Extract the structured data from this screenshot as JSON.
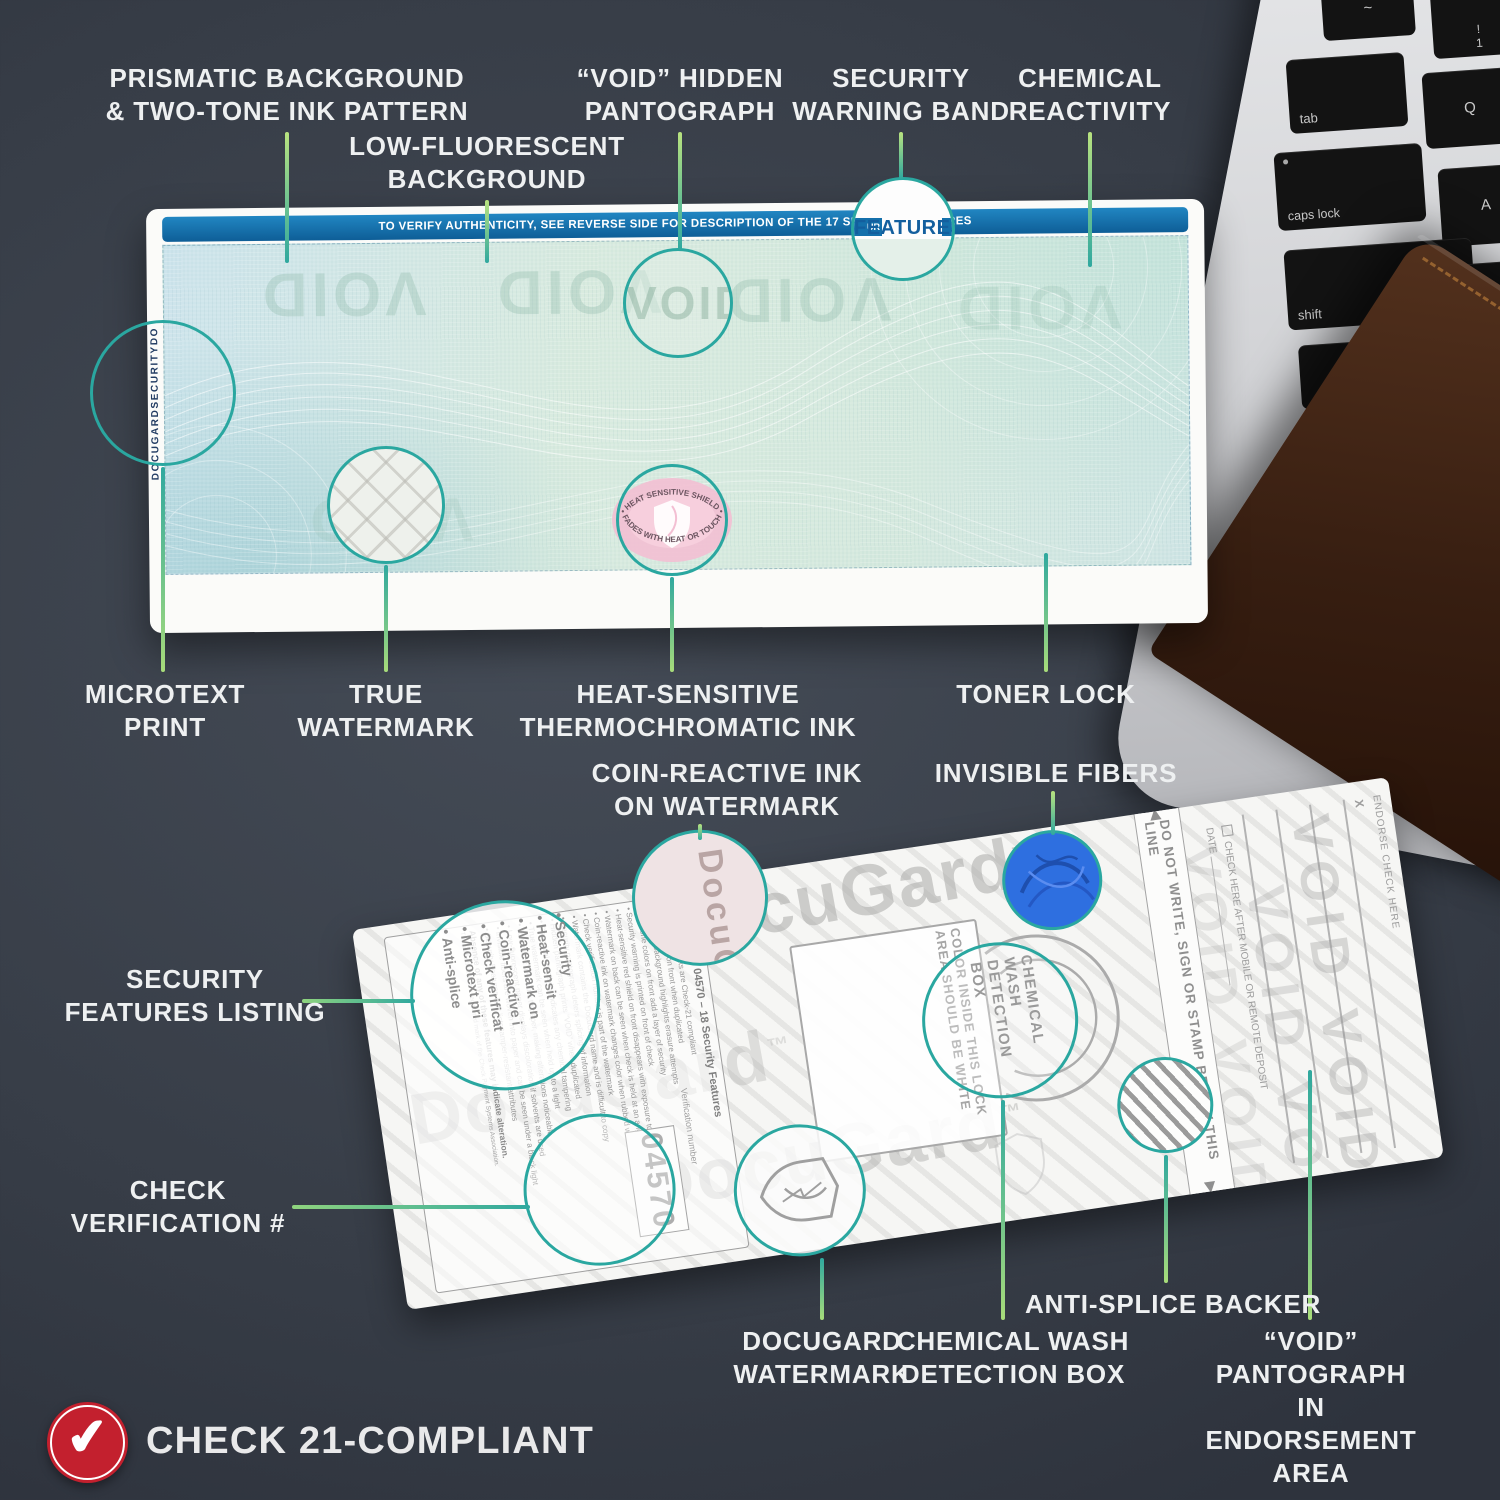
{
  "callouts": {
    "prismatic": "PRISMATIC BACKGROUND\n& TWO-TONE INK PATTERN",
    "low_fluorescent": "LOW-FLUORESCENT\nBACKGROUND",
    "void_hidden": "“VOID” HIDDEN\nPANTOGRAPH",
    "security_warning": "SECURITY\nWARNING BAND",
    "chemical_reactivity": "CHEMICAL\nREACTIVITY",
    "microtext_print": "MICROTEXT\nPRINT",
    "true_watermark": "TRUE\nWATERMARK",
    "heat_sensitive": "HEAT-SENSITIVE\nTHERMOCHROMATIC INK",
    "toner_lock": "TONER LOCK",
    "coin_reactive": "COIN-REACTIVE INK\nON WATERMARK",
    "invisible_fibers": "INVISIBLE FIBERS",
    "security_features_listing": "SECURITY\nFEATURES LISTING",
    "check_verification": "CHECK\nVERIFICATION #",
    "docugard_watermark": "DOCUGARD\nWATERMARK",
    "chemical_wash_box": "CHEMICAL WASH\nDETECTION BOX",
    "anti_splice": "ANTI-SPLICE BACKER",
    "void_endorsement": "“VOID” PANTOGRAPH\nIN ENDORSEMENT\nAREA"
  },
  "front_check": {
    "band_text": "TO VERIFY AUTHENTICITY, SEE REVERSE SIDE FOR DESCRIPTION OF THE 17 SECURITY FEATURES",
    "features_magnified": "FEATURES",
    "band_fragment": "UR",
    "void_text": "VOID",
    "microtext": "DOCUGARDSECURITYDO",
    "heat_shield_top": "• HEAT SENSITIVE SHIELD •",
    "heat_shield_bottom": "FADES WITH HEAT OR TOUCH"
  },
  "back_check": {
    "watermark_text": "DocuGard",
    "watermark_tm": "™",
    "listing": {
      "heading": "DocuGard 04570 – 18 Security Features",
      "bullets": [
        "DocuGard checks are Check-21 compliant",
        "Prints “VOID” on front when duplicated",
        "Patterned background highlights erasure attempts",
        "Two-tone colors on front add a layer of security",
        "Security warning is printed on front of check",
        "Heat-sensitive red shield on front disappears with exposure to heat or touch",
        "Watermark on back can be seen when check is held at an angle",
        "Coin-reactive ink on watermark changes color when rubbed with a coin",
        "Check verification number is part of the watermark",
        "Watermark contains the DocuGard name and is difficult to copy",
        "Security pantograph deters splicing of information",
        "Hidden pantograph prints “VOID” when duplicated",
        "Chemical reactivity indicates any chemical tampering",
        "True watermark can be seen when held up to a light",
        "Toner lock fuses ink to paper, making alterations noticeable",
        "Low-fluorescent paper displays discoloration if solvents are used",
        "Invisible fibers are woven into paper and can be seen under a black light",
        "Security Features Box lists tamper-resistant attributes"
      ],
      "footer": "Absence of any of these features may indicate alteration.",
      "footnote": "The padlock icon is a registered mark of the Check Payment Systems Association."
    },
    "magnified_lines": [
      "Security",
      "Heat-sensit",
      "Watermark on",
      "Coin-reactive i",
      "Check verificat",
      "Microtext pri",
      "Anti-splice"
    ],
    "verification_number": "04570",
    "verification_caption": "Verification number",
    "lock_box_text": "COLOR INSIDE THIS LOCK\nAREA SHOULD BE WHITE",
    "magnifier_chem_text": "CHEMICAL WASH\nDETECTION BOX",
    "endorsement": {
      "endorse_here": "ENDORSE CHECK HERE",
      "x_mark": "X",
      "checkbox_label": "CHECK HERE AFTER MOBILE OR REMOTE DEPOSIT",
      "date_label": "DATE",
      "do_not_write": "DO NOT WRITE, SIGN OR STAMP BELOW THIS LINE",
      "arrow_up": "◀",
      "arrow_down": "▶",
      "void_pantograph": "VOID VOID"
    }
  },
  "keyboard": {
    "tilde": "~",
    "one_top": "!",
    "one_bottom": "1",
    "tab": "tab",
    "q": "Q",
    "caps_lock": "caps lock",
    "a": "A",
    "shift": "shift",
    "z": "Z"
  },
  "badge": {
    "label": "CHECK 21-COMPLIANT",
    "check_glyph": "✔"
  },
  "colors": {
    "accent_teal": "#2aa7a0",
    "accent_green": "#a9dc7a",
    "band_blue": "#1470ab",
    "badge_red": "#c3202e",
    "fiber_blue": "#2e6fe0"
  }
}
